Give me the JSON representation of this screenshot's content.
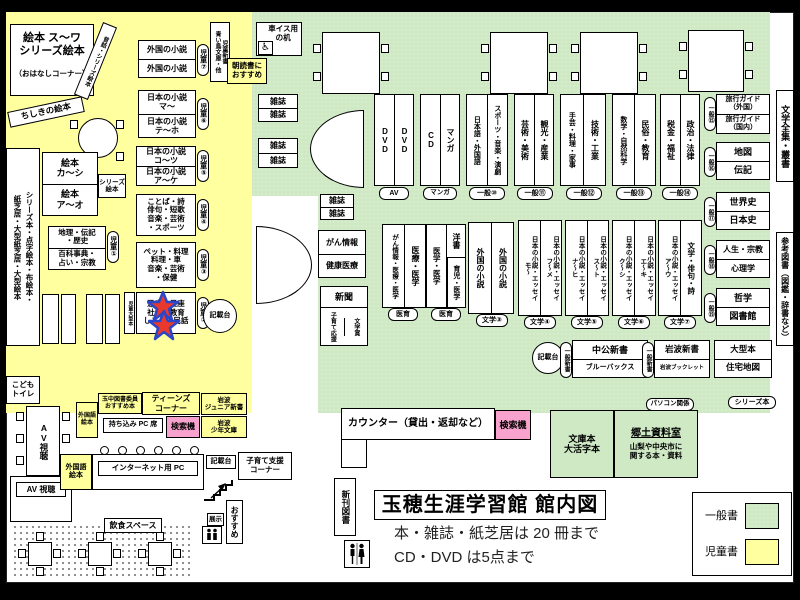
{
  "colors": {
    "children_bg": "#FFFF9C",
    "general_bg": "#CFE9C5",
    "search_bg": "#F7A3CD",
    "star_fill": "#E9392B",
    "star_stroke": "#2B46C8"
  },
  "legend": {
    "general": "一般書",
    "children": "児童書"
  },
  "title": {
    "name": "玉穂生涯学習館 館内図",
    "rule_books": "本・雑誌・紙芝居は 20 冊まで",
    "rule_av": "CD・DVD は5点まで"
  },
  "icons": {
    "wheelchair": "♿",
    "elevator_arrows": "↓↑"
  },
  "facilities": {
    "counter": "カウンター（貸出・返却など）",
    "search": "検索機",
    "new_books": "新刊図書",
    "wheelchair_desk": "車イス用\nの机",
    "kids_toilet": "こども\nトイレ",
    "av_view": "AV視聴",
    "av_view2": "AV 視聴",
    "internet_pc": "インターネット用 PC",
    "byod_pc": "持ち込み PC 席",
    "writing_desk": "記載台",
    "kosodate_corner": "子育て支援\nコーナー",
    "eat_space": "飲食スペース",
    "osusume": "おすすめ",
    "tenji": "展示",
    "morning": "朝読書に\nおすすめ"
  },
  "children": {
    "ohanashi": "絵本 ス～ワ\nシリーズ絵本",
    "ohanashi2": "（おはなしコーナー）",
    "mukashi": "昔話・シリーズ絵本",
    "chishiki": "ちしきの絵本",
    "strip": "シリーズ本・点字絵本・布絵本・\n紙芝居・大型紙芝居・大型絵本",
    "aoitori": "児童新書\n青い鳥文庫・他",
    "large_books": "児童大型本",
    "shelf7_rows": [
      "外国の小説",
      "外国の小説"
    ],
    "shelf7_tag": "児童⑦",
    "shelf6_rows": [
      "日本の小説\nマ～",
      "日本の小説\nテ～ホ"
    ],
    "shelf6_tag": "児童⑥",
    "shelf5_rows": [
      "日本の小説\nコ～ツ",
      "日本の小説\nア～ケ"
    ],
    "shelf5_tag": "児童⑤",
    "shelf4_text": "ことば・詩\n俳句・短歌\n音楽・芸術\n・スポーツ",
    "shelf4_tag": "児童④",
    "shelf3_text": "ペット・料理\n料理・車\n音楽・芸術\n・保健",
    "shelf3_tag": "児童③",
    "shelf2_text": "恐竜・星座\n社会・教育\nしごと・民話",
    "shelf2_tag": "児童②",
    "shelf1_rows": [
      "地理・伝記\n・歴史",
      "百科事典・\n占い・宗教"
    ],
    "shelf1_tag": "児童①",
    "ehon_rows": [
      "絵本\nカ～シ",
      "絵本\nア～オ"
    ],
    "ehon_tag": "シリーズ\n絵本"
  },
  "teens": {
    "foreign_picture": "外国語\n絵本",
    "tamachu": "玉中図書委員\nおすすめ本",
    "corner": "ティーンズ\nコーナー",
    "iwanami_junior": "岩波\nジュニア新書",
    "iwanami_shonen": "岩波\n少年文庫"
  },
  "general": {
    "magazine": "雑誌",
    "cancer_info": "がん情報",
    "health": "健康医療",
    "newspaper": "新聞",
    "kosodate_ouen": "子育て応援",
    "bungakusho": "文学賞",
    "units": [
      {
        "col1": "DVD",
        "col2": "DVD",
        "tag": "AV"
      },
      {
        "col1": "CD",
        "col2": "マンガ",
        "tag": "マンガ"
      },
      {
        "col1": "日本語・外国語",
        "col2": "スポーツ・音楽・演劇",
        "tag": "一般⑩"
      },
      {
        "col1": "芸術・美術",
        "col2": "観光・産業",
        "tag": "一般⑪"
      },
      {
        "col1": "手芸・料理・家事",
        "col2": "技術・工業",
        "tag": "一般⑫"
      },
      {
        "col1": "数学・自然科学",
        "col2": "民俗・教育",
        "tag": "一般⑬"
      },
      {
        "col1": "税金・福祉",
        "col2": "政治・法律",
        "tag": "一般⑭"
      }
    ],
    "med": [
      {
        "col1": "がん情報・医療・医学",
        "col2": "医療・医学",
        "tag": "医育"
      },
      {
        "col1": "医学・医学",
        "col2a": "洋書",
        "col2b": "育児・医学",
        "tag": "医育"
      }
    ],
    "lit": [
      {
        "col1": "外国の小説",
        "col2": "外国の小説",
        "tag": "文学③"
      },
      {
        "col1": "日本の小説・エッセイ\nモ～",
        "col2": "日本の小説・エッセイ\nフ～メ",
        "tag": "文学④"
      },
      {
        "col1": "日本の小説・エッセイ\nナ～ヒ",
        "col2": "日本の小説・エッセイ\nス～ト",
        "tag": "文学⑤"
      },
      {
        "col1": "日本の小説・エッセイ\nク～シ",
        "col2": "日本の小説・エッセイ\nエ～キ",
        "tag": "文学⑥"
      },
      {
        "col1": "日本の小説・エッセイ\nア～ウ",
        "col2": "文学・俳句・詩",
        "tag": "文学⑦"
      }
    ],
    "right_shelves": [
      {
        "row1": "旅行ガイド\n（外国）",
        "row2": "旅行ガイド\n（国内）",
        "tag": "一般⑮"
      },
      {
        "row1": "地図",
        "row2": "伝記",
        "tag": "一般⑯"
      },
      {
        "row1": "世界史",
        "row2": "日本史",
        "tag": "一般⑰"
      },
      {
        "row1": "人生・宗教",
        "row2": "心理学",
        "tag": "一般⑱"
      },
      {
        "row1": "哲学",
        "row2": "図書館",
        "tag": "一般⑲"
      }
    ],
    "zenshu": "文学全集・叢書",
    "sanko": "参考図書（図鑑・辞書など）",
    "shinsho1_rows": [
      "中公新書",
      "ブルーバックス"
    ],
    "shinsho1_tag": "一般新書",
    "shinsho2_rows": [
      "岩波新書",
      "岩波ブックレット"
    ],
    "shinsho2_tag": "一般新書",
    "ogata_rows": [
      "大型本",
      "住宅地図"
    ],
    "series_tag": "シリーズ本",
    "pc_tag": "パソコン関係",
    "bunko": "文庫本\n大活字本",
    "kyodo_title": "郷土資料室",
    "kyodo_desc": "山梨や中央市に\n関する本・資料"
  }
}
